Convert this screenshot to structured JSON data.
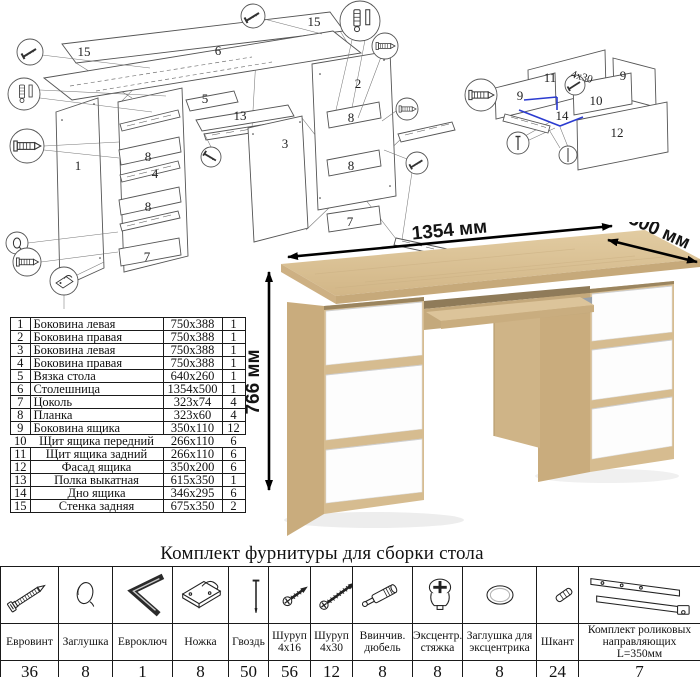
{
  "document": {
    "type": "furniture-assembly-sheet",
    "product": "стол"
  },
  "dimensions": {
    "width": "1354 мм",
    "depth": "500 мм",
    "height": "766 мм"
  },
  "diagram": {
    "main_labels": [
      "15",
      "6",
      "15",
      "1",
      "8",
      "4",
      "8",
      "7",
      "5",
      "13",
      "3",
      "2",
      "8",
      "8",
      "7"
    ],
    "drawer_labels": [
      "11",
      "9",
      "9",
      "10",
      "14",
      "12",
      "4x30"
    ]
  },
  "parts_table": {
    "rows": [
      {
        "num": "1",
        "name": "Боковина левая",
        "size": "750x388",
        "qty": "1"
      },
      {
        "num": "2",
        "name": "Боковина правая",
        "size": "750x388",
        "qty": "1"
      },
      {
        "num": "3",
        "name": "Боковина левая",
        "size": "750x388",
        "qty": "1"
      },
      {
        "num": "4",
        "name": "Боковина правая",
        "size": "750x388",
        "qty": "1"
      },
      {
        "num": "5",
        "name": "Вязка стола",
        "size": "640x260",
        "qty": "1"
      },
      {
        "num": "6",
        "name": "Столешница",
        "size": "1354x500",
        "qty": "1"
      },
      {
        "num": "7",
        "name": "Цоколь",
        "size": "323x74",
        "qty": "4"
      },
      {
        "num": "8",
        "name": "Планка",
        "size": "323x60",
        "qty": "4"
      },
      {
        "num": "9",
        "name": "Боковина ящика",
        "size": "350x110",
        "qty": "12"
      },
      {
        "num": "10",
        "name": "Щит ящика передний",
        "size": "266x110",
        "qty": "6"
      },
      {
        "num": "11",
        "name": "Щит ящика задний",
        "size": "266x110",
        "qty": "6"
      },
      {
        "num": "12",
        "name": "Фасад ящика",
        "size": "350x200",
        "qty": "6"
      },
      {
        "num": "13",
        "name": "Полка выкатная",
        "size": "615x350",
        "qty": "1"
      },
      {
        "num": "14",
        "name": "Дно ящика",
        "size": "346x295",
        "qty": "6"
      },
      {
        "num": "15",
        "name": "Стенка задняя",
        "size": "675x350",
        "qty": "2"
      }
    ]
  },
  "hardware": {
    "title": "Комплект фурнитуры для сборки стола",
    "items": [
      {
        "name": "Евровинт",
        "qty": "36",
        "icon": "euroscrew-icon"
      },
      {
        "name": "Заглушка",
        "qty": "8",
        "icon": "cap-icon"
      },
      {
        "name": "Евроключ",
        "qty": "1",
        "icon": "hexkey-icon"
      },
      {
        "name": "Ножка",
        "qty": "8",
        "icon": "foot-icon"
      },
      {
        "name": "Гвоздь",
        "qty": "50",
        "icon": "nail-icon"
      },
      {
        "name": "Шуруп\n4х16",
        "qty": "56",
        "icon": "screw-short-icon"
      },
      {
        "name": "Шуруп\n4х30",
        "qty": "12",
        "icon": "screw-long-icon"
      },
      {
        "name": "Ввинчив.\nдюбель",
        "qty": "8",
        "icon": "dowel-screw-icon"
      },
      {
        "name": "Эксцентр.\nстяжка",
        "qty": "8",
        "icon": "cam-lock-icon"
      },
      {
        "name": "Заглушка для\nэксцентрика",
        "qty": "8",
        "icon": "cam-cap-icon"
      },
      {
        "name": "Шкант",
        "qty": "24",
        "icon": "wood-dowel-icon"
      },
      {
        "name": "Комплект роликовых\nнаправляющих L=350мм",
        "qty": "7",
        "icon": "drawer-rail-icon"
      }
    ]
  },
  "colors": {
    "oak": "#d6bc90",
    "oak_dark": "#c9ac7d",
    "oak_edge": "#c6a97a",
    "niche_shadow": "#8f7b59",
    "drawer_white": "#fdfdfd",
    "line": "#555555",
    "accent_blue": "#2b3bd0",
    "text": "#111111"
  }
}
